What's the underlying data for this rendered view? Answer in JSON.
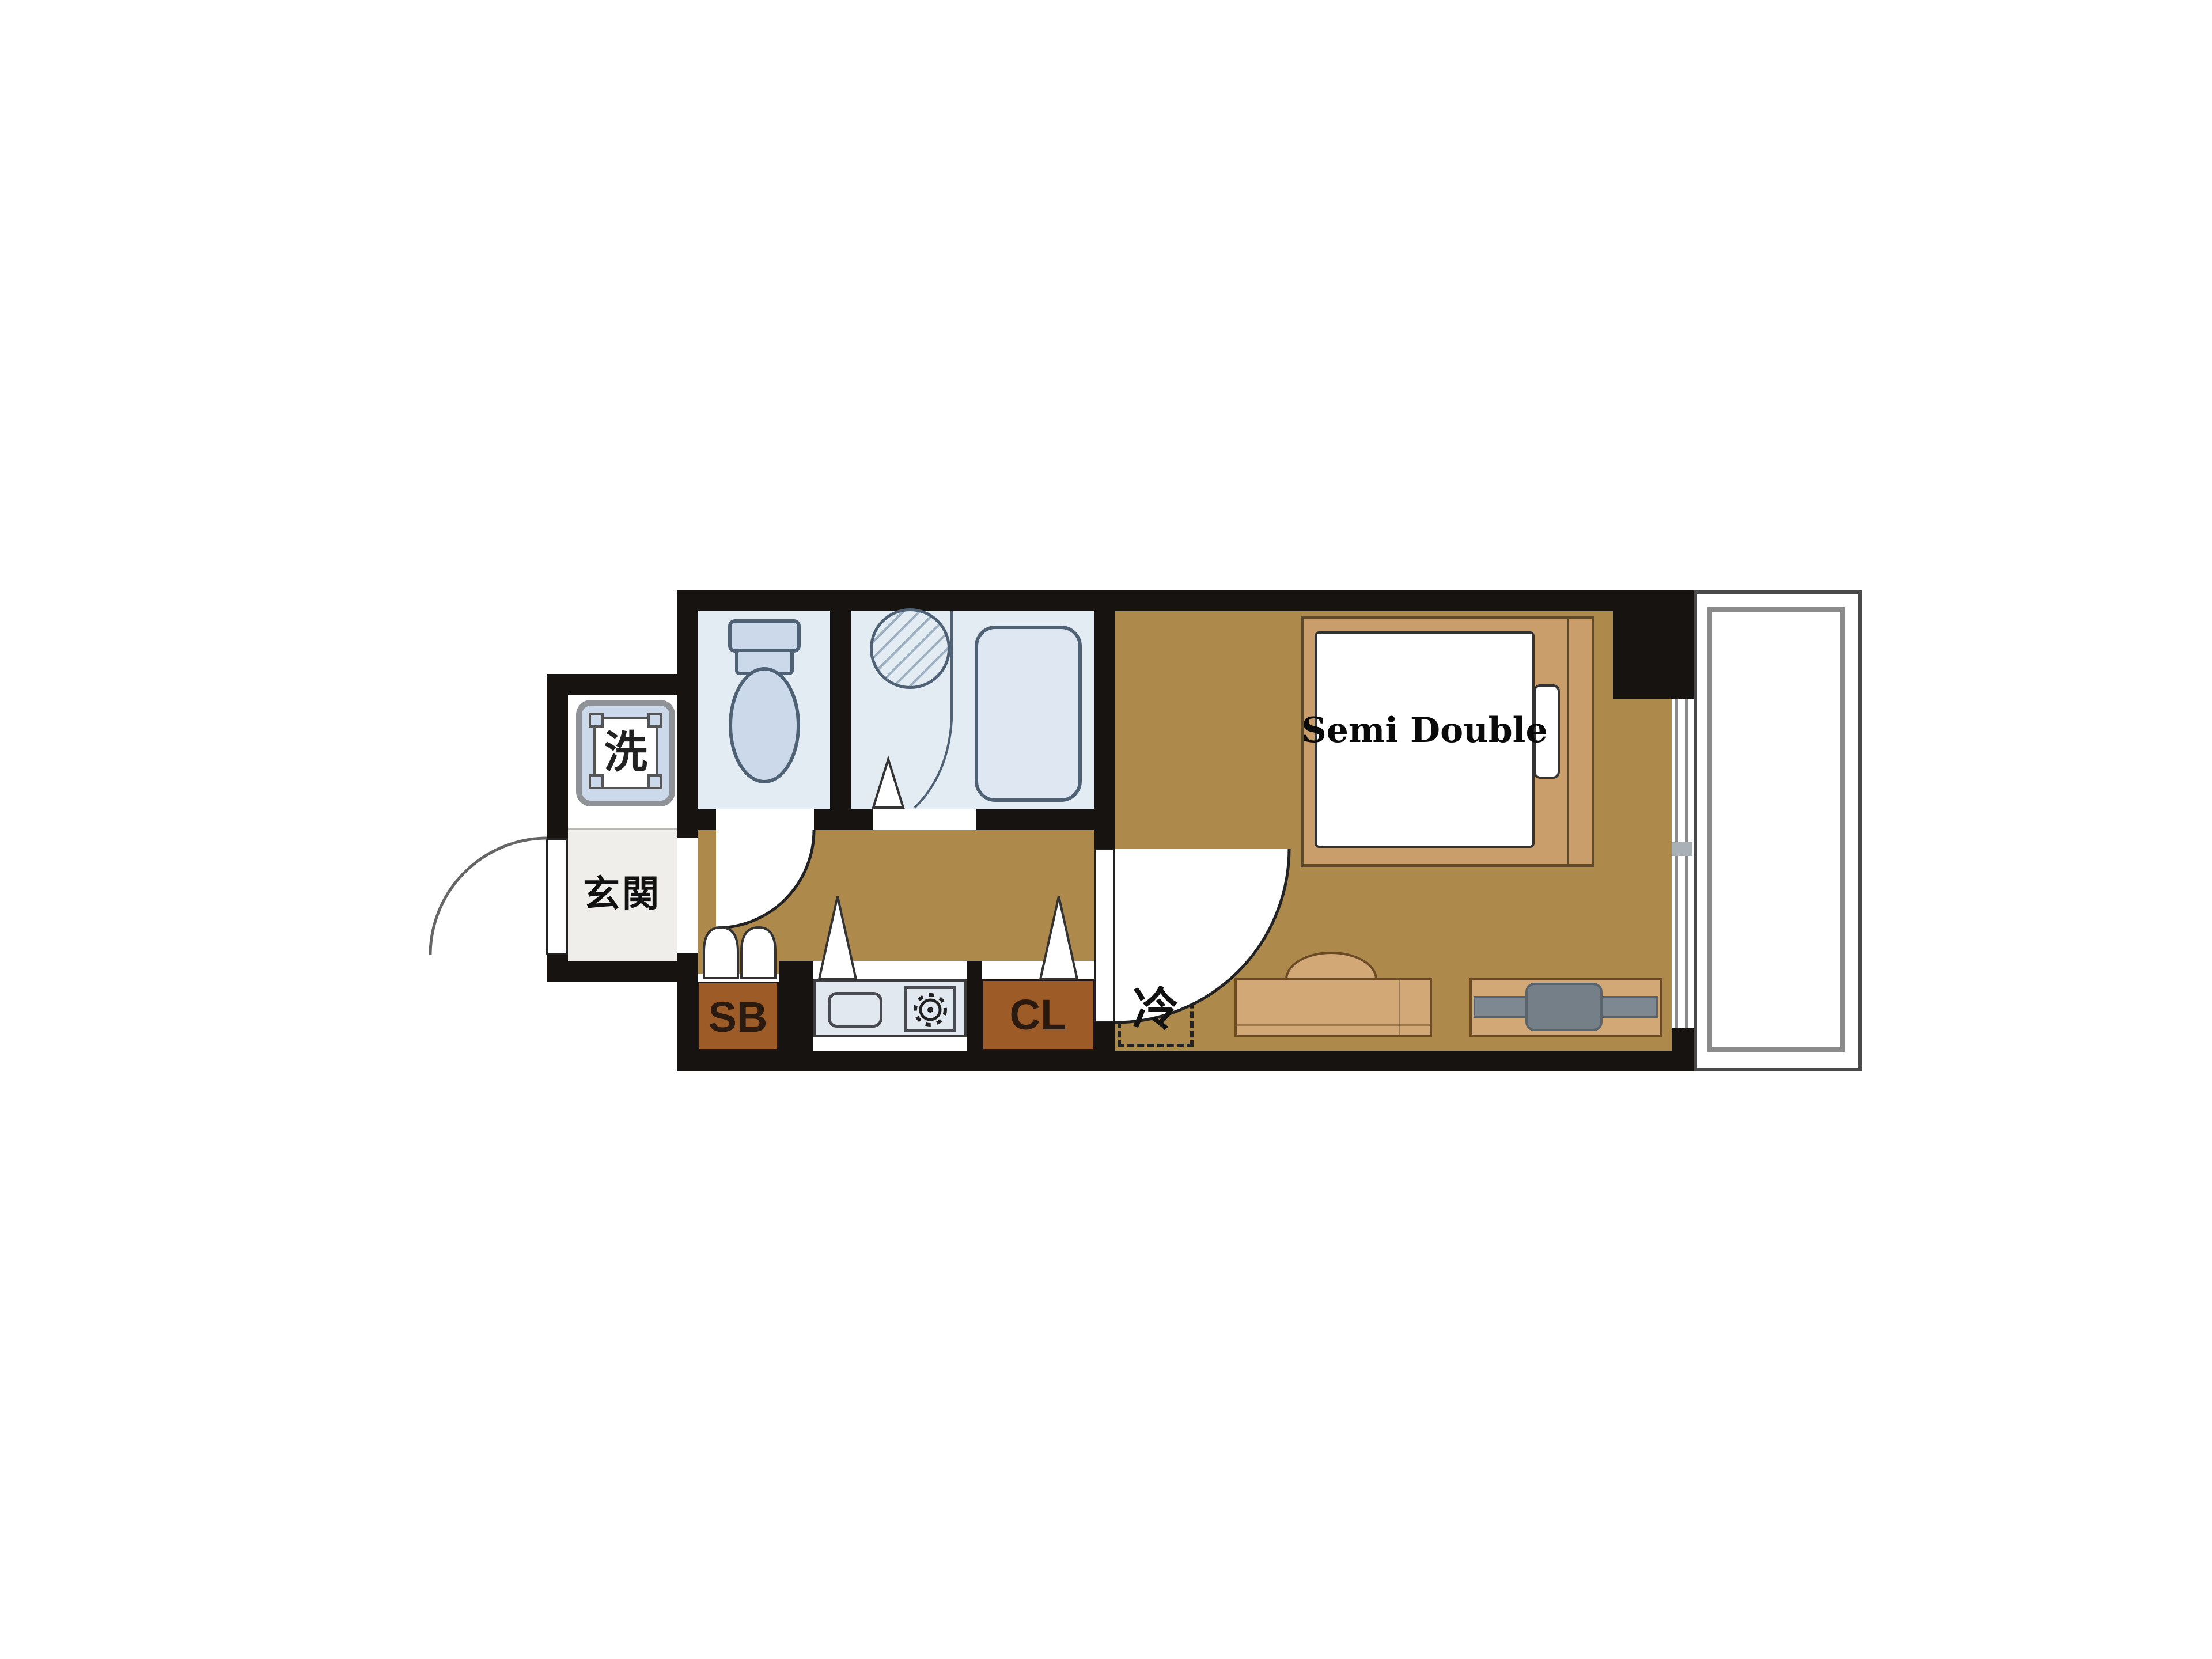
{
  "title": "1K apartment floor plan",
  "labels": {
    "washing_machine": "洗",
    "entrance": "玄関",
    "shoe_box": "SB",
    "closet": "CL",
    "refrigerator": "冷",
    "bed": "Semi Double"
  },
  "rooms": [
    "toilet",
    "bathroom",
    "hallway",
    "kitchen",
    "main-room",
    "entrance",
    "balcony"
  ],
  "colors": {
    "background": "#ffffff",
    "wall": "#171310",
    "floor": "#ad8a4c",
    "wet_room": "#e3ebf3",
    "fixture_fill": "#cbd9ea",
    "fixture_stroke": "#4f6175",
    "cabinet": "#9d5b28",
    "cabinet_text": "#2b1a10",
    "furniture": "#d2a877",
    "furniture_stroke": "#6b4a26",
    "bed_frame": "#c99e6b",
    "counter": "#e2e8ef",
    "tv": "#7d8890",
    "balcony_line": "#8a8a8a",
    "genkan_floor": "#efeeeb"
  }
}
